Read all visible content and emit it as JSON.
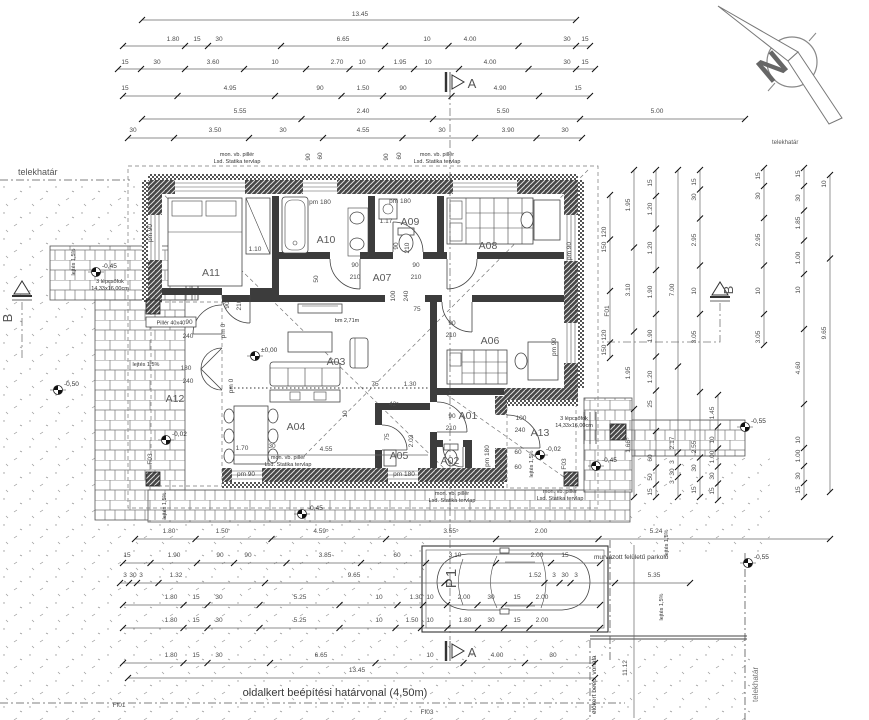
{
  "north_label": "N",
  "sections": {
    "a": "A",
    "b": "B"
  },
  "parking": {
    "label": "P1",
    "note": "murvázott felületű parkoló"
  },
  "annotations": {
    "telekhatar_left": "telekhatár",
    "telekhatar_top_right": "telekhatár",
    "telekhatar_right": "telekhatár",
    "oldalkert": "oldalkert beépítési határvonal (4,50m)",
    "elokert": "előkert beép. vonala",
    "bm": "bm 2,71m",
    "pillar": "Pillér 40x40",
    "statika_1": "mon. vb. pillér",
    "statika_2": "Lsd. Statika tervlap",
    "steps_1": "3 lépcsőfok",
    "steps_2": "14,33x16,00cm",
    "slope": "lejtés 1,5%"
  },
  "rooms": [
    {
      "id": "A01",
      "x": 468,
      "y": 419
    },
    {
      "id": "A02",
      "x": 450,
      "y": 464
    },
    {
      "id": "A03",
      "x": 336,
      "y": 365
    },
    {
      "id": "A04",
      "x": 296,
      "y": 430
    },
    {
      "id": "A05",
      "x": 399,
      "y": 459
    },
    {
      "id": "A06",
      "x": 490,
      "y": 344
    },
    {
      "id": "A07",
      "x": 382,
      "y": 281
    },
    {
      "id": "A08",
      "x": 488,
      "y": 249
    },
    {
      "id": "A09",
      "x": 410,
      "y": 225
    },
    {
      "id": "A10",
      "x": 326,
      "y": 243
    },
    {
      "id": "A11",
      "x": 211,
      "y": 276
    },
    {
      "id": "A12",
      "x": 175,
      "y": 402
    },
    {
      "id": "A13",
      "x": 540,
      "y": 436
    }
  ],
  "levels": [
    {
      "x": 255,
      "y": 356,
      "t": "±0,00"
    },
    {
      "x": 166,
      "y": 440,
      "t": "-0,02"
    },
    {
      "x": 540,
      "y": 455,
      "t": "-0,02"
    },
    {
      "x": 96,
      "y": 272,
      "t": "-0,45"
    },
    {
      "x": 302,
      "y": 514,
      "t": "-0,45"
    },
    {
      "x": 596,
      "y": 466,
      "t": "-0,45"
    },
    {
      "x": 58,
      "y": 390,
      "t": "-0,50"
    },
    {
      "x": 745,
      "y": 427,
      "t": "-0,55"
    },
    {
      "x": 748,
      "y": 563,
      "t": "-0,55"
    }
  ],
  "statika_positions": [
    {
      "x": 237,
      "y": 156
    },
    {
      "x": 437,
      "y": 156
    },
    {
      "x": 288,
      "y": 459
    },
    {
      "x": 452,
      "y": 495
    },
    {
      "x": 560,
      "y": 493
    }
  ],
  "steps_positions": [
    {
      "x": 110,
      "y": 283
    },
    {
      "x": 574,
      "y": 420
    }
  ],
  "slope_positions": [
    {
      "x": 75,
      "y": 262,
      "r": 1
    },
    {
      "x": 146,
      "y": 366,
      "r": 0
    },
    {
      "x": 166,
      "y": 506,
      "r": 1
    },
    {
      "x": 533,
      "y": 464,
      "r": 1
    },
    {
      "x": 668,
      "y": 543,
      "r": 1
    },
    {
      "x": 663,
      "y": 607,
      "r": 1
    }
  ],
  "f_labels": [
    {
      "x": 119,
      "y": 707,
      "t": "Ff01",
      "r": 0
    },
    {
      "x": 427,
      "y": 714,
      "t": "Ff03",
      "r": 0
    },
    {
      "x": 609,
      "y": 311,
      "t": "F01",
      "r": 1
    },
    {
      "x": 566,
      "y": 464,
      "t": "F03",
      "r": 1
    },
    {
      "x": 152,
      "y": 459,
      "t": "F03",
      "r": 1
    }
  ],
  "plan_labels": [
    {
      "x": 152,
      "y": 233,
      "t": "pm 90",
      "r": 1
    },
    {
      "x": 320,
      "y": 204,
      "t": "pm 180",
      "r": 0
    },
    {
      "x": 400,
      "y": 203,
      "t": "pm 180",
      "r": 0
    },
    {
      "x": 571,
      "y": 251,
      "t": "pm 90",
      "r": 1
    },
    {
      "x": 556,
      "y": 347,
      "t": "pm 90",
      "r": 1
    },
    {
      "x": 489,
      "y": 456,
      "t": "pm 180",
      "r": 1
    },
    {
      "x": 404,
      "y": 476,
      "t": "pm 180",
      "r": 0
    },
    {
      "x": 246,
      "y": 476,
      "t": "pm 90",
      "r": 0
    },
    {
      "x": 355,
      "y": 267,
      "t": "90",
      "r": 0
    },
    {
      "x": 355,
      "y": 279,
      "t": "210",
      "r": 0
    },
    {
      "x": 416,
      "y": 267,
      "t": "90",
      "r": 0
    },
    {
      "x": 416,
      "y": 279,
      "t": "210",
      "r": 0
    },
    {
      "x": 229,
      "y": 305,
      "t": "90",
      "r": 1
    },
    {
      "x": 241,
      "y": 305,
      "t": "210",
      "r": 1
    },
    {
      "x": 398,
      "y": 246,
      "t": "90",
      "r": 1
    },
    {
      "x": 409,
      "y": 248,
      "t": "210",
      "r": 1
    },
    {
      "x": 318,
      "y": 279,
      "t": "50",
      "r": 1
    },
    {
      "x": 452,
      "y": 325,
      "t": "90",
      "r": 0
    },
    {
      "x": 451,
      "y": 337,
      "t": "210",
      "r": 0
    },
    {
      "x": 452,
      "y": 418,
      "t": "90",
      "r": 0
    },
    {
      "x": 451,
      "y": 430,
      "t": "210",
      "r": 0
    },
    {
      "x": 389,
      "y": 437,
      "t": "75",
      "r": 1
    },
    {
      "x": 521,
      "y": 420,
      "t": "100",
      "r": 0
    },
    {
      "x": 520,
      "y": 432,
      "t": "240",
      "r": 0
    },
    {
      "x": 518,
      "y": 454,
      "t": "60",
      "r": 0
    },
    {
      "x": 518,
      "y": 469,
      "t": "60",
      "r": 0
    },
    {
      "x": 189,
      "y": 324,
      "t": "90",
      "r": 0
    },
    {
      "x": 188,
      "y": 338,
      "t": "240",
      "r": 0
    },
    {
      "x": 186,
      "y": 370,
      "t": "180",
      "r": 0
    },
    {
      "x": 188,
      "y": 383,
      "t": "240",
      "r": 0
    },
    {
      "x": 225,
      "y": 331,
      "t": "pm 0",
      "r": 1
    },
    {
      "x": 233,
      "y": 386,
      "t": "pm 0",
      "r": 1
    },
    {
      "x": 255,
      "y": 251,
      "t": "1.10",
      "r": 0
    },
    {
      "x": 386,
      "y": 223,
      "t": "1.17",
      "r": 0
    },
    {
      "x": 326,
      "y": 451,
      "t": "4.55",
      "r": 0
    },
    {
      "x": 272,
      "y": 448,
      "t": "30",
      "r": 0
    },
    {
      "x": 242,
      "y": 450,
      "t": "1.70",
      "r": 0
    },
    {
      "x": 413,
      "y": 441,
      "t": "2.03",
      "r": 1
    },
    {
      "x": 347,
      "y": 414,
      "t": "10",
      "r": 1
    },
    {
      "x": 375,
      "y": 386,
      "t": "75",
      "r": 0
    },
    {
      "x": 410,
      "y": 386,
      "t": "1.30",
      "r": 0
    },
    {
      "x": 394,
      "y": 406,
      "t": "42⁵",
      "r": 0
    },
    {
      "x": 310,
      "y": 157,
      "t": "90",
      "r": 1
    },
    {
      "x": 322,
      "y": 156,
      "t": "60",
      "r": 1
    },
    {
      "x": 388,
      "y": 157,
      "t": "90",
      "r": 1
    },
    {
      "x": 401,
      "y": 156,
      "t": "60",
      "r": 1
    },
    {
      "x": 395,
      "y": 296,
      "t": "100",
      "r": 1
    },
    {
      "x": 408,
      "y": 296,
      "t": "240",
      "r": 1
    },
    {
      "x": 417,
      "y": 311,
      "t": "75",
      "r": 0
    },
    {
      "x": 627,
      "y": 668,
      "t": "11.12",
      "r": 1
    }
  ],
  "top_dims": [
    {
      "y": 16,
      "ly": 20,
      "x1": 142,
      "x2": 576,
      "labels": [
        {
          "x": 360,
          "t": "13.45"
        }
      ]
    },
    {
      "y": 41,
      "ly": 46,
      "x1": 123,
      "x2": 590,
      "labels": [
        {
          "x": 173,
          "t": "1.80"
        },
        {
          "x": 197,
          "t": "15"
        },
        {
          "x": 219,
          "t": "30"
        },
        {
          "x": 343,
          "t": "6.65"
        },
        {
          "x": 427,
          "t": "10"
        },
        {
          "x": 470,
          "t": "4.00"
        },
        {
          "x": 567,
          "t": "30"
        },
        {
          "x": 585,
          "t": "15"
        }
      ]
    },
    {
      "y": 64,
      "ly": 69,
      "x1": 118,
      "x2": 595,
      "labels": [
        {
          "x": 125,
          "t": "15"
        },
        {
          "x": 157,
          "t": "30"
        },
        {
          "x": 213,
          "t": "3.60"
        },
        {
          "x": 275,
          "t": "10"
        },
        {
          "x": 337,
          "t": "2.70"
        },
        {
          "x": 362,
          "t": "10"
        },
        {
          "x": 400,
          "t": "1.95"
        },
        {
          "x": 428,
          "t": "10"
        },
        {
          "x": 490,
          "t": "4.00"
        },
        {
          "x": 567,
          "t": "30"
        },
        {
          "x": 585,
          "t": "15"
        }
      ]
    },
    {
      "y": 90,
      "ly": 96,
      "x1": 123,
      "x2": 590,
      "labels": [
        {
          "x": 125,
          "t": "15"
        },
        {
          "x": 230,
          "t": "4.95"
        },
        {
          "x": 320,
          "t": "90"
        },
        {
          "x": 363,
          "t": "1.50"
        },
        {
          "x": 403,
          "t": "90"
        },
        {
          "x": 500,
          "t": "4.90"
        },
        {
          "x": 578,
          "t": "15"
        }
      ]
    },
    {
      "y": 113,
      "ly": 119,
      "x1": 142,
      "x2": 745,
      "labels": [
        {
          "x": 240,
          "t": "5.55"
        },
        {
          "x": 363,
          "t": "2.40"
        },
        {
          "x": 503,
          "t": "5.50"
        },
        {
          "x": 657,
          "t": "5.00"
        }
      ]
    },
    {
      "y": 132,
      "ly": 138,
      "x1": 128,
      "x2": 582,
      "labels": [
        {
          "x": 133,
          "t": "30"
        },
        {
          "x": 215,
          "t": "3.50"
        },
        {
          "x": 283,
          "t": "30"
        },
        {
          "x": 363,
          "t": "4.55"
        },
        {
          "x": 442,
          "t": "30"
        },
        {
          "x": 508,
          "t": "3.90"
        },
        {
          "x": 565,
          "t": "30"
        }
      ]
    }
  ],
  "bottom_dims": [
    {
      "y": 533,
      "ly": 539,
      "x1": 135,
      "x2": 830,
      "labels": [
        {
          "x": 169,
          "t": "1.80"
        },
        {
          "x": 222,
          "t": "1.50"
        },
        {
          "x": 321,
          "t": "4.59⁵"
        },
        {
          "x": 451,
          "t": "3.55⁵"
        },
        {
          "x": 541,
          "t": "2.00"
        },
        {
          "x": 656,
          "t": "5.24"
        }
      ]
    },
    {
      "y": 557,
      "ly": 563,
      "x1": 123,
      "x2": 600,
      "labels": [
        {
          "x": 127,
          "t": "15"
        },
        {
          "x": 174,
          "t": "1.90"
        },
        {
          "x": 220,
          "t": "90"
        },
        {
          "x": 248,
          "t": "90"
        },
        {
          "x": 325,
          "t": "3.85"
        },
        {
          "x": 397,
          "t": "60"
        },
        {
          "x": 455,
          "t": "3.10"
        },
        {
          "x": 537,
          "t": "2.00"
        },
        {
          "x": 565,
          "t": "15"
        }
      ]
    },
    {
      "y": 577,
      "ly": 583,
      "x1": 120,
      "x2": 690,
      "labels": [
        {
          "x": 125,
          "t": "3"
        },
        {
          "x": 133,
          "t": "30"
        },
        {
          "x": 141,
          "t": "3"
        },
        {
          "x": 176,
          "t": "1.32"
        },
        {
          "x": 354,
          "t": "9.65"
        },
        {
          "x": 535,
          "t": "1.52"
        },
        {
          "x": 554,
          "t": "3"
        },
        {
          "x": 565,
          "t": "30"
        },
        {
          "x": 576,
          "t": "3"
        },
        {
          "x": 654,
          "t": "5.35"
        }
      ]
    },
    {
      "y": 599,
      "ly": 605,
      "x1": 123,
      "x2": 600,
      "labels": [
        {
          "x": 171,
          "t": "1.80"
        },
        {
          "x": 196,
          "t": "15"
        },
        {
          "x": 219,
          "t": "30"
        },
        {
          "x": 300,
          "t": "5.25"
        },
        {
          "x": 379,
          "t": "10"
        },
        {
          "x": 416,
          "t": "1.30"
        },
        {
          "x": 430,
          "t": "10"
        },
        {
          "x": 464,
          "t": "2.00"
        },
        {
          "x": 491,
          "t": "30"
        },
        {
          "x": 517,
          "t": "15"
        },
        {
          "x": 542,
          "t": "2.00"
        }
      ]
    },
    {
      "y": 622,
      "ly": 628,
      "x1": 123,
      "x2": 600,
      "labels": [
        {
          "x": 171,
          "t": "1.80"
        },
        {
          "x": 196,
          "t": "15"
        },
        {
          "x": 219,
          "t": "30"
        },
        {
          "x": 300,
          "t": "5.25"
        },
        {
          "x": 379,
          "t": "10"
        },
        {
          "x": 412,
          "t": "1.50"
        },
        {
          "x": 430,
          "t": "10"
        },
        {
          "x": 465,
          "t": "1.80"
        },
        {
          "x": 491,
          "t": "30"
        },
        {
          "x": 517,
          "t": "15"
        },
        {
          "x": 542,
          "t": "2.00"
        }
      ]
    },
    {
      "y": 657,
      "ly": 663,
      "x1": 123,
      "x2": 595,
      "labels": [
        {
          "x": 171,
          "t": "1.80"
        },
        {
          "x": 196,
          "t": "15"
        },
        {
          "x": 219,
          "t": "30"
        },
        {
          "x": 321,
          "t": "6.65"
        },
        {
          "x": 430,
          "t": "10"
        },
        {
          "x": 497,
          "t": "4.00"
        },
        {
          "x": 553,
          "t": "30"
        }
      ]
    },
    {
      "y": 672,
      "ly": 678,
      "x1": 128,
      "x2": 595,
      "labels": [
        {
          "x": 357,
          "t": "13.45"
        }
      ]
    }
  ],
  "right_dims": [
    {
      "x": 606,
      "lx": 610,
      "y1": 195,
      "y2": 358,
      "labels": [
        {
          "y": 232,
          "t": "120"
        },
        {
          "y": 247,
          "t": "150"
        },
        {
          "y": 335,
          "t": "120"
        },
        {
          "y": 350,
          "t": "150"
        }
      ]
    },
    {
      "x": 630,
      "lx": 634,
      "y1": 170,
      "y2": 497,
      "labels": [
        {
          "y": 205,
          "t": "1.95"
        },
        {
          "y": 290,
          "t": "3.10"
        },
        {
          "y": 373,
          "t": "1.95"
        },
        {
          "y": 445,
          "t": "1.66⁵"
        }
      ]
    },
    {
      "x": 652,
      "lx": 656,
      "y1": 170,
      "y2": 497,
      "labels": [
        {
          "y": 183,
          "t": "15"
        },
        {
          "y": 209,
          "t": "1.20"
        },
        {
          "y": 248,
          "t": "1.20"
        },
        {
          "y": 292,
          "t": "1.90"
        },
        {
          "y": 336,
          "t": "1.90"
        },
        {
          "y": 377,
          "t": "1.20"
        },
        {
          "y": 404,
          "t": "25"
        },
        {
          "y": 458,
          "t": "60"
        },
        {
          "y": 477,
          "t": "50"
        },
        {
          "y": 492,
          "t": "15"
        }
      ]
    },
    {
      "x": 674,
      "lx": 678,
      "y1": 170,
      "y2": 497,
      "labels": [
        {
          "y": 290,
          "t": "7.00"
        },
        {
          "y": 443,
          "t": "2.17"
        },
        {
          "y": 462,
          "t": "3"
        },
        {
          "y": 472,
          "t": "30"
        },
        {
          "y": 482,
          "t": "3"
        }
      ]
    },
    {
      "x": 696,
      "lx": 700,
      "y1": 170,
      "y2": 497,
      "labels": [
        {
          "y": 182,
          "t": "15"
        },
        {
          "y": 197,
          "t": "30"
        },
        {
          "y": 240,
          "t": "2.95"
        },
        {
          "y": 291,
          "t": "10"
        },
        {
          "y": 337,
          "t": "3.05"
        },
        {
          "y": 447,
          "t": "2.55"
        },
        {
          "y": 468,
          "t": "30"
        },
        {
          "y": 490,
          "t": "15"
        }
      ]
    },
    {
      "x": 714,
      "lx": 718,
      "y1": 395,
      "y2": 500,
      "labels": [
        {
          "y": 413,
          "t": "1.45"
        },
        {
          "y": 440,
          "t": "10"
        },
        {
          "y": 457,
          "t": "1.00"
        },
        {
          "y": 476,
          "t": "30"
        },
        {
          "y": 491,
          "t": "15"
        }
      ]
    },
    {
      "x": 760,
      "lx": 764,
      "y1": 168,
      "y2": 345,
      "labels": [
        {
          "y": 176,
          "t": "15"
        },
        {
          "y": 196,
          "t": "30"
        },
        {
          "y": 240,
          "t": "2.95"
        },
        {
          "y": 291,
          "t": "10"
        },
        {
          "y": 337,
          "t": "3.05"
        }
      ]
    },
    {
      "x": 800,
      "lx": 804,
      "y1": 168,
      "y2": 497,
      "labels": [
        {
          "y": 174,
          "t": "15"
        },
        {
          "y": 198,
          "t": "30"
        },
        {
          "y": 223,
          "t": "1.85"
        },
        {
          "y": 258,
          "t": "1.00"
        },
        {
          "y": 290,
          "t": "10"
        },
        {
          "y": 368,
          "t": "4.60"
        },
        {
          "y": 440,
          "t": "10"
        },
        {
          "y": 456,
          "t": "1.00"
        },
        {
          "y": 476,
          "t": "30"
        },
        {
          "y": 490,
          "t": "15"
        }
      ]
    },
    {
      "x": 826,
      "lx": 830,
      "y1": 175,
      "y2": 492,
      "labels": [
        {
          "y": 184,
          "t": "10"
        },
        {
          "y": 333,
          "t": "9.65"
        }
      ]
    }
  ]
}
